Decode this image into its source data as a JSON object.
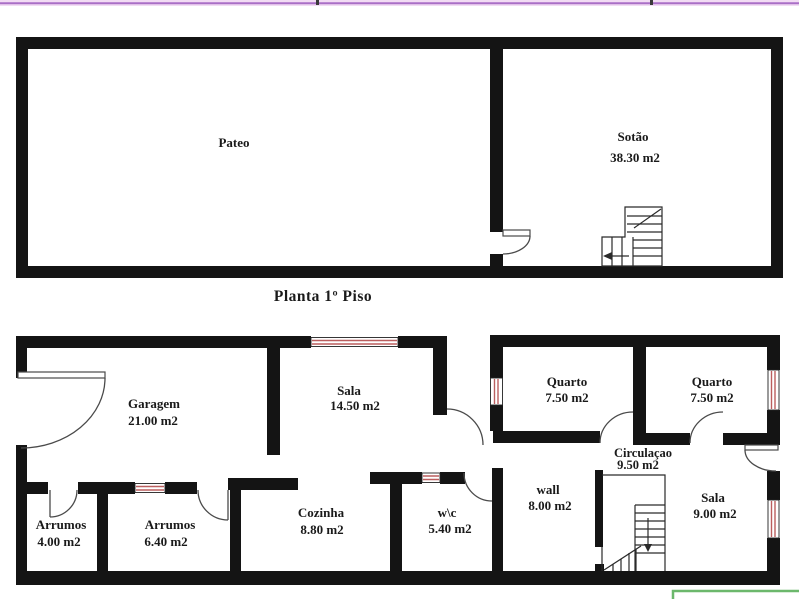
{
  "colors": {
    "wall": "#141414",
    "window_accent": "#bb5f5f",
    "band_bg": "#f2dcf4",
    "band_line": "#a96fc6",
    "green_box": "#6cb86c",
    "text": "#1a1a1a"
  },
  "caption": "Planta 1º Piso",
  "upper_plan": {
    "pateo": {
      "name": "Pateo"
    },
    "sotao": {
      "name": "Sotão",
      "area": "38.30 m2"
    }
  },
  "lower_plan": {
    "garagem": {
      "name": "Garagem",
      "area": "21.00 m2"
    },
    "sala_grande": {
      "name": "Sala",
      "area": "14.50 m2"
    },
    "quarto_1": {
      "name": "Quarto",
      "area": "7.50 m2"
    },
    "quarto_2": {
      "name": "Quarto",
      "area": "7.50 m2"
    },
    "circulacao": {
      "name": "Circulaçao",
      "area": "9.50 m2"
    },
    "arrumos_1": {
      "name": "Arrumos",
      "area": "4.00 m2"
    },
    "arrumos_2": {
      "name": "Arrumos",
      "area": "6.40 m2"
    },
    "cozinha": {
      "name": "Cozinha",
      "area": "8.80 m2"
    },
    "wc": {
      "name": "w\\c",
      "area": "5.40 m2"
    },
    "hall": {
      "name": "wall",
      "area": "8.00 m2"
    },
    "sala_pequena": {
      "name": "Sala",
      "area": "9.00 m2"
    }
  }
}
